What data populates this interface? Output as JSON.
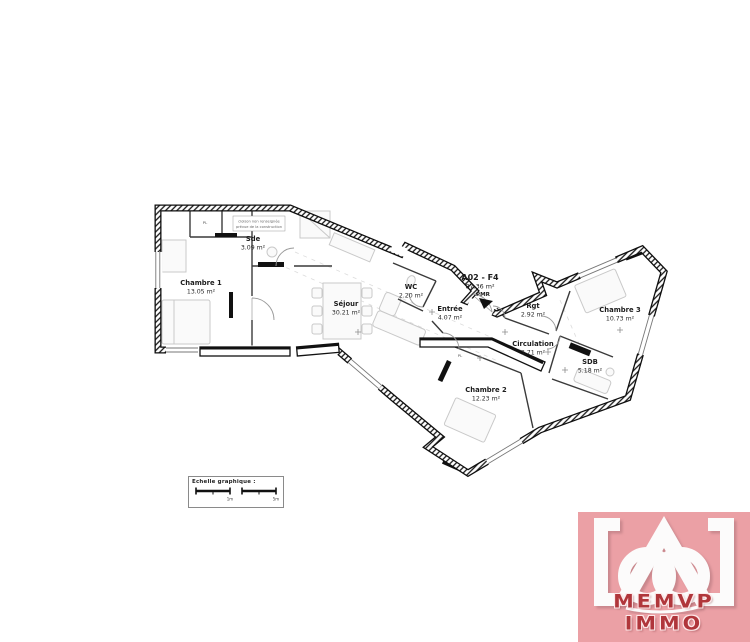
{
  "plan": {
    "unit": {
      "id": "A02 - F4",
      "area": "87.36 m²",
      "tag": "PMR"
    },
    "note_line1": "cloison non renseignée",
    "note_line2": "prévue de la construction",
    "closet": "PL",
    "rooms": [
      {
        "name": "Chambre 1",
        "area": "13.05 m²"
      },
      {
        "name": "Sde",
        "area": "3.09 m²"
      },
      {
        "name": "Séjour",
        "area": "30.21 m²"
      },
      {
        "name": "WC",
        "area": "2.20 m²"
      },
      {
        "name": "Entrée",
        "area": "4.07 m²"
      },
      {
        "name": "Rgt",
        "area": "2.92 m²"
      },
      {
        "name": "Circulation",
        "area": "3.71 m²"
      },
      {
        "name": "Chambre 2",
        "area": "12.23 m²"
      },
      {
        "name": "Chambre 3",
        "area": "10.73 m²"
      },
      {
        "name": "SDB",
        "area": "5.18 m²"
      }
    ]
  },
  "scale_bar": {
    "title": "Echelle graphique :",
    "label_1": "1m",
    "label_2": "5m"
  },
  "logo": {
    "brand": "MEMVP IMMO",
    "bg_color": "#eba0a5",
    "text_color": "#b0363b"
  }
}
